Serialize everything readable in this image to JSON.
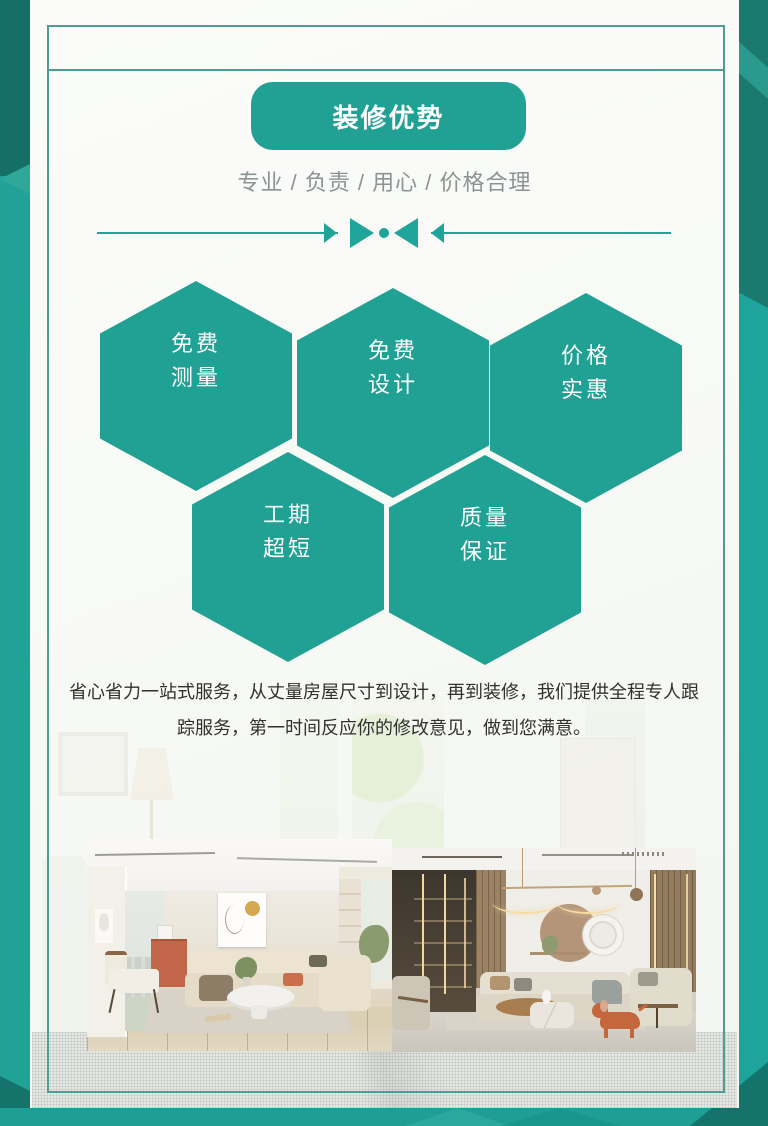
{
  "page": {
    "badge_label": "装修优势",
    "subtitle": "专业 / 负责 / 用心 / 价格合理",
    "hexagons": [
      {
        "line1": "免费",
        "line2": "测量"
      },
      {
        "line1": "免费",
        "line2": "设计"
      },
      {
        "line1": "价格",
        "line2": "实惠"
      },
      {
        "line1": "工期",
        "line2": "超短"
      },
      {
        "line1": "质量",
        "line2": "保证"
      }
    ],
    "paragraph": "省心省力一站式服务，从丈量房屋尺寸到设计，再到装修，我们提供全程专人跟踪服务，第一时间反应你的修改意见，做到您满意。",
    "photos": [
      {
        "label": "浅色现代客厅"
      },
      {
        "label": "暖色轻奢客厅"
      }
    ],
    "colors": {
      "teal": "#21A094",
      "teal_background": "#1EA49B",
      "teal_dark": "#156F66",
      "frame_line": "#4E9C94",
      "subtitle_gray": "#8C9394",
      "paragraph_text": "#303030",
      "card_background": "#F8FAF6"
    }
  }
}
